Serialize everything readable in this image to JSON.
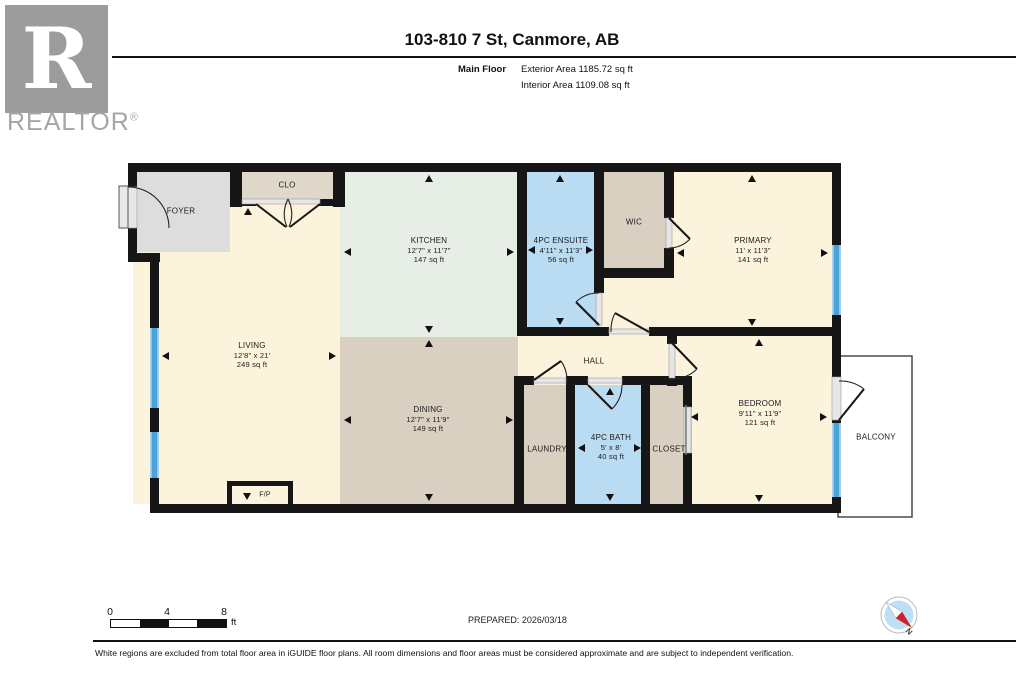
{
  "logo": {
    "brand": "REALTOR",
    "reg": "®",
    "letter": "R"
  },
  "header": {
    "title": "103-810 7 St, Canmore, AB",
    "floor_label": "Main Floor",
    "exterior_area": "Exterior Area 1185.72 sq ft",
    "interior_area": "Interior Area 1109.08 sq ft"
  },
  "rooms": {
    "foyer": {
      "name": "FOYER"
    },
    "clo": {
      "name": "CLO"
    },
    "kitchen": {
      "name": "KITCHEN",
      "dims": "12'7\" x 11'7\"",
      "area": "147 sq ft"
    },
    "ensuite": {
      "name": "4PC ENSUITE",
      "dims": "4'11\" x 11'3\"",
      "area": "56 sq ft"
    },
    "wic": {
      "name": "WIC"
    },
    "primary": {
      "name": "PRIMARY",
      "dims": "11' x 11'3\"",
      "area": "141 sq ft"
    },
    "living": {
      "name": "LIVING",
      "dims": "12'8\" x 21'",
      "area": "249 sq ft"
    },
    "dining": {
      "name": "DINING",
      "dims": "12'7\" x 11'9\"",
      "area": "149 sq ft"
    },
    "hall": {
      "name": "HALL"
    },
    "laundry": {
      "name": "LAUNDRY"
    },
    "bath": {
      "name": "4PC BATH",
      "dims": "5' x 8'",
      "area": "40 sq ft"
    },
    "closet": {
      "name": "CLOSET"
    },
    "bedroom": {
      "name": "BEDROOM",
      "dims": "9'11\" x 11'9\"",
      "area": "121 sq ft"
    },
    "balcony": {
      "name": "BALCONY"
    },
    "fireplace": {
      "name": "F/P"
    }
  },
  "scale_bar": {
    "tick0": "0",
    "tick1": "4",
    "tick2": "8",
    "unit": "ft"
  },
  "compass": {
    "north": "N"
  },
  "footer": {
    "prepared": "PREPARED: 2026/03/18",
    "disclaimer": "White regions are excluded from total floor area in iGUIDE floor plans. All room dimensions and floor areas must be considered approximate and are subject to independent verification."
  },
  "colors": {
    "wall": "#161616",
    "cream": "#FBF3DC",
    "tan": "#D9D0C1",
    "kitchen_green": "#E6EEE6",
    "room_blue": "#B9DCF3",
    "foyer_gray": "#DDDDDD",
    "window_blue": "#4DA2D9"
  }
}
